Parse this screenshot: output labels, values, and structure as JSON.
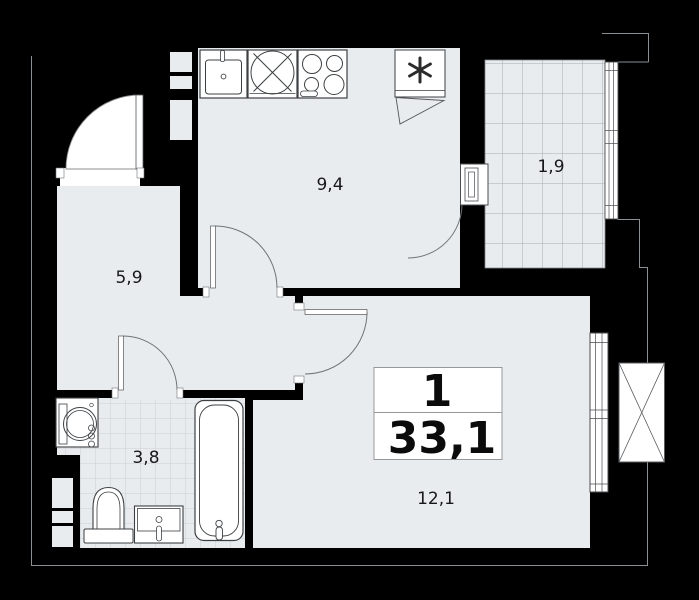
{
  "plan": {
    "title": "apartment-floor-plan",
    "summary": {
      "rooms_count": "1",
      "total_area": "33,1"
    },
    "rooms": [
      {
        "id": "kitchen",
        "area": "9,4"
      },
      {
        "id": "balcony",
        "area": "1,9"
      },
      {
        "id": "hallway",
        "area": "5,9"
      },
      {
        "id": "bathroom",
        "area": "3,8"
      },
      {
        "id": "living-room",
        "area": "12,1"
      }
    ],
    "icons": [
      "sink-icon",
      "hob-icon",
      "stove-icon",
      "fridge-snowflake-icon",
      "washing-machine-icon",
      "toilet-icon",
      "vanity-sink-icon",
      "bathtub-icon",
      "ac-unit-icon",
      "door-arc",
      "window"
    ],
    "colors": {
      "wall": "#000000",
      "floor": "#e9ecef",
      "fixture": "#ffffff",
      "outline": "#8a8f94",
      "balcony_grid": "#a6abb1",
      "tile_grid": "#ccd1d6",
      "text": "#17181a"
    }
  }
}
